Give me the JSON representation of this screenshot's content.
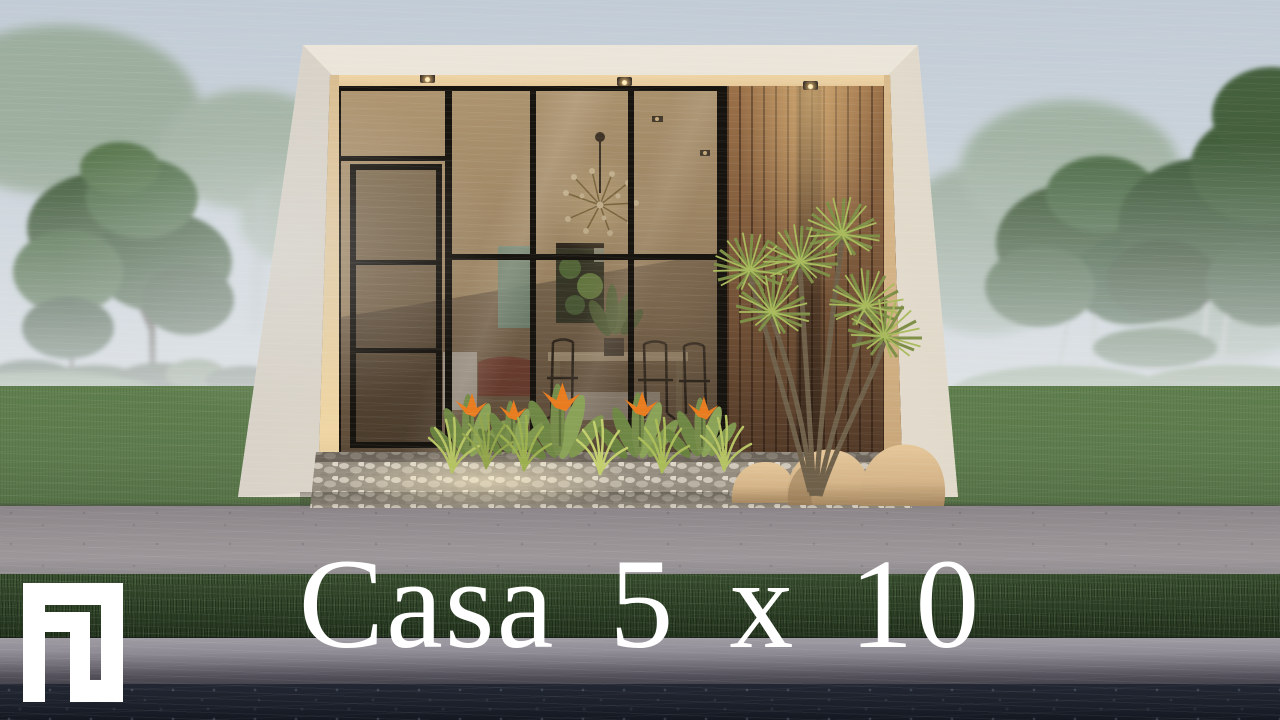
{
  "title": {
    "text": "Casa 5 x 10"
  },
  "logo": {
    "label": "FG monogram logo",
    "glyph": "FG"
  },
  "scene": {
    "subject": "modern minimalist house render",
    "weather": "rain and fog",
    "elements": [
      "glass facade",
      "wood slat panel",
      "dracaena plant",
      "bird of paradise flowers",
      "pebble bed",
      "lawn",
      "trees",
      "sidewalk",
      "curb",
      "road"
    ]
  },
  "colors": {
    "sky-top": "#c2ccd6",
    "sky-low": "#dde2e6",
    "tree-dark": "#3c5836",
    "tree-mid": "#4e6c45",
    "tree-misty": "#8ea289",
    "birch": "#ccd1ca",
    "lawn": "#5e7c4e",
    "mound": "#6e8c5a",
    "hedge": "#2b3f25",
    "sidewalk": "#979093",
    "grass-strip": "#2d4126",
    "curb": "#908c96",
    "curb-face": "#54515b",
    "road": "#1b202a",
    "shell": "#e8e2d6",
    "shell-shade": "#d5cfc5",
    "soffit": "#e7cb9c",
    "jamb": "#e5cc9e",
    "mullion": "#17130e",
    "glass-dark": "#50402f",
    "ceiling": "#c7ab7f",
    "wall-in": "#8f7a5f",
    "wood": "#7a573a",
    "wood-dark": "#4a3424",
    "glow": "#ffe6ad",
    "teal": "#7fb0a0",
    "table": "#cbb897",
    "leaf": "#768c4a",
    "tuft": "#b5c363",
    "flower": "#e87c1e",
    "pebble": "#cfc8ba",
    "rock": "#d4b488",
    "title": "#ffffff",
    "logo": "#ffffff"
  }
}
